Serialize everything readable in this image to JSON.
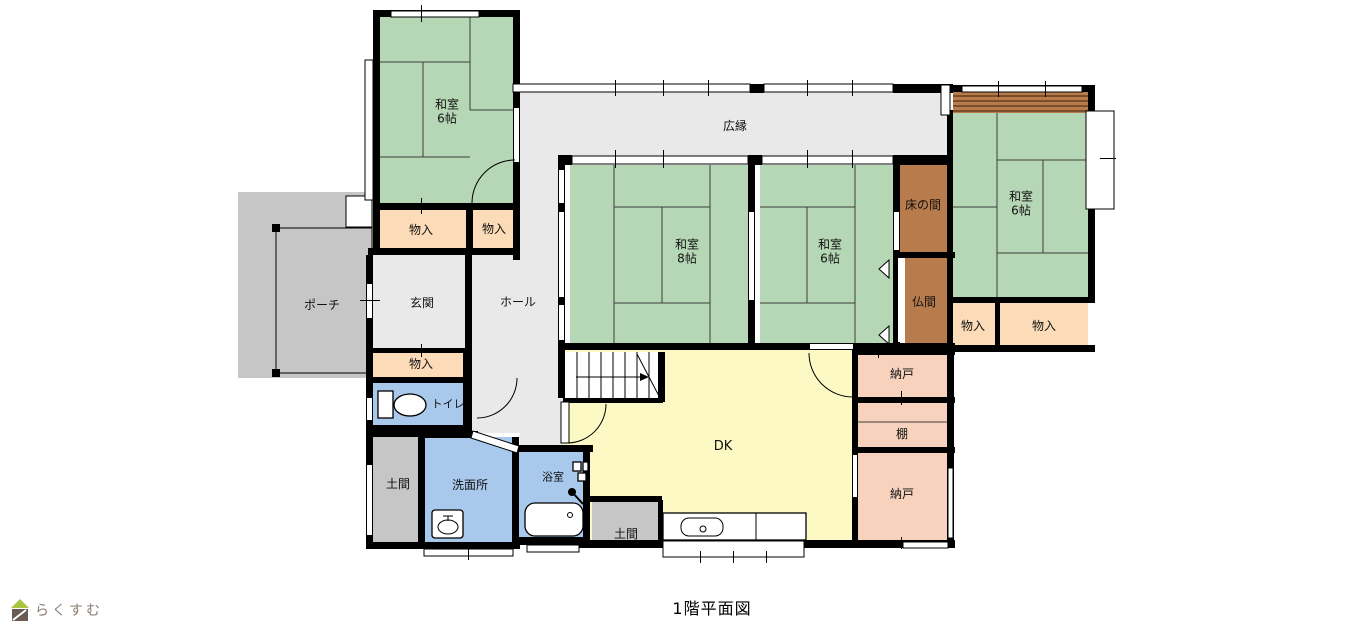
{
  "palette": {
    "wall": "#000000",
    "tatami": "#b6d7b6",
    "storage": "#fcdcb8",
    "closet": "#f7d3bd",
    "alcove": "#b87c4c",
    "alcove_stripe": "#7a4e28",
    "water": "#a9c9ec",
    "dk": "#fcf9c4",
    "gray_room": "#e9e9e9",
    "gray_porch": "#c6c6c6",
    "logo_green": "#a9c43f",
    "logo_brown": "#6b5d54",
    "logo_text": "#8b7d72"
  },
  "rooms": {
    "washitsu_nw": "和室\n6帖",
    "washitsu_8": "和室\n8帖",
    "washitsu_c": "和室\n6帖",
    "washitsu_e": "和室\n6帖",
    "hiroen": "広縁",
    "monoire": "物入",
    "tokonoma": "床の間",
    "butsuma": "仏間",
    "porch": "ポーチ",
    "genkan": "玄関",
    "hall": "ホール",
    "toilet": "トイレ",
    "doma": "土間",
    "senmenjo": "洗面所",
    "yokushitsu": "浴室",
    "dk": "DK",
    "nando": "納戸",
    "tana": "棚"
  },
  "icons": {
    "toilet": "toilet-icon",
    "bathtub": "bathtub-icon",
    "washbasin": "washbasin-icon",
    "shower": "shower-icon",
    "kitchen_sink": "kitchen-sink-icon",
    "stairs": "stairs-icon",
    "logo": "house-icon"
  },
  "caption": "1階平面図",
  "logo": {
    "text": "らくすむ"
  }
}
